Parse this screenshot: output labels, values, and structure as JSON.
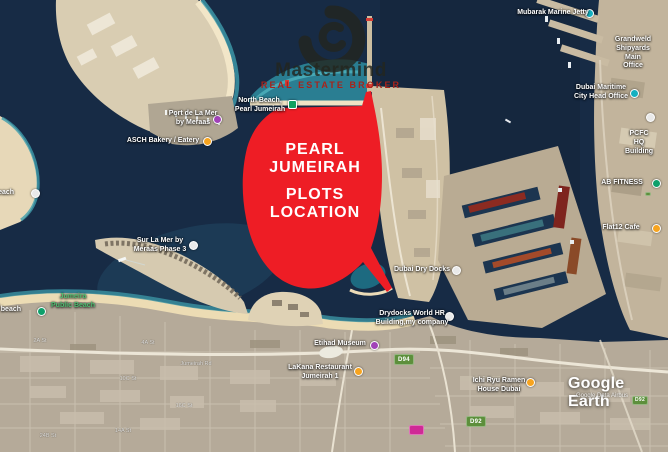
{
  "brand": {
    "name": "Mastermind",
    "tagline": "REAL ESTATE BROKER",
    "logo_icon": "swirl-wave-icon",
    "tagline_color": "#a8231b"
  },
  "overlay": {
    "group1": "PEARL\nJUMEIRAH",
    "group2": "PLOTS\nLOCATION",
    "fill_color": "#ee1d25",
    "text_color": "#ffffff"
  },
  "watermark": {
    "brand": "Google Earth",
    "attribution": "Google Data Airbus"
  },
  "labels": [
    {
      "id": "mubarak-marine-jetty",
      "text": "Mubarak Marine Jetty",
      "marker": "teal"
    },
    {
      "id": "grandweld-shipyards",
      "text": "Grandweld Shipyards\nMain Office",
      "marker": "none"
    },
    {
      "id": "dubai-maritime-city-head-office",
      "text": "Dubai Maritime\nCity Head Office",
      "marker": "teal"
    },
    {
      "id": "pcfc-hq-building",
      "text": "PCFC HQ Building",
      "marker": "white"
    },
    {
      "id": "ab-fitness",
      "text": "AB FITNESS",
      "marker": "green"
    },
    {
      "id": "flat12-cafe",
      "text": "Flat12 Cafe",
      "marker": "orange"
    },
    {
      "id": "north-beach-pearl-jumeirah",
      "text": "North Beach,\nPearl Jumeirah",
      "marker": "green-square"
    },
    {
      "id": "port-de-la-mer",
      "text": "Port de La Mer\nby Meraas",
      "marker": "purple"
    },
    {
      "id": "asch-bakery-eatery",
      "text": "ASCH Bakery / Eatery",
      "marker": "orange"
    },
    {
      "id": "li-beach",
      "text": "li beach",
      "marker": "white"
    },
    {
      "id": "sur-la-mer",
      "text": "Sur La Mer by\nMeraas Phase 3",
      "marker": "white"
    },
    {
      "id": "jumeira-public-beach",
      "text": "Jumeira\nPublic Beach",
      "marker": "none"
    },
    {
      "id": "mer-beach",
      "text": "mer beach",
      "marker": "green"
    },
    {
      "id": "dubai-dry-docks",
      "text": "Dubai Dry Docks",
      "marker": "white"
    },
    {
      "id": "drydocks-world-hr",
      "text": "Drydocks World HR\nBuilding,my company",
      "marker": "white"
    },
    {
      "id": "etihad-museum",
      "text": "Etihad Museum",
      "marker": "purple"
    },
    {
      "id": "lakana-restaurant",
      "text": "LaKana Restaurant\nJumeirah 1",
      "marker": "orange"
    },
    {
      "id": "ichi-ryu-ramen",
      "text": "Ichi Ryu Ramen\nHouse Dubai",
      "marker": "orange"
    }
  ],
  "road_badges": [
    {
      "id": "d94",
      "label": "D94"
    },
    {
      "id": "d92",
      "label": "D92"
    },
    {
      "id": "d92-edge",
      "label": "D92"
    }
  ],
  "streets": [
    "2A St",
    "4A St",
    "10C St",
    "16C St",
    "14A St",
    "24B St",
    "Jumeirah Rd"
  ],
  "map_colors": {
    "deep_water": "#172b45",
    "shallow_water": "#3b93a2",
    "sand": "#ecdcb4",
    "urban": "#b5aa99",
    "port_land": "#c2b49c",
    "overlay_red": "#ee1d25"
  }
}
